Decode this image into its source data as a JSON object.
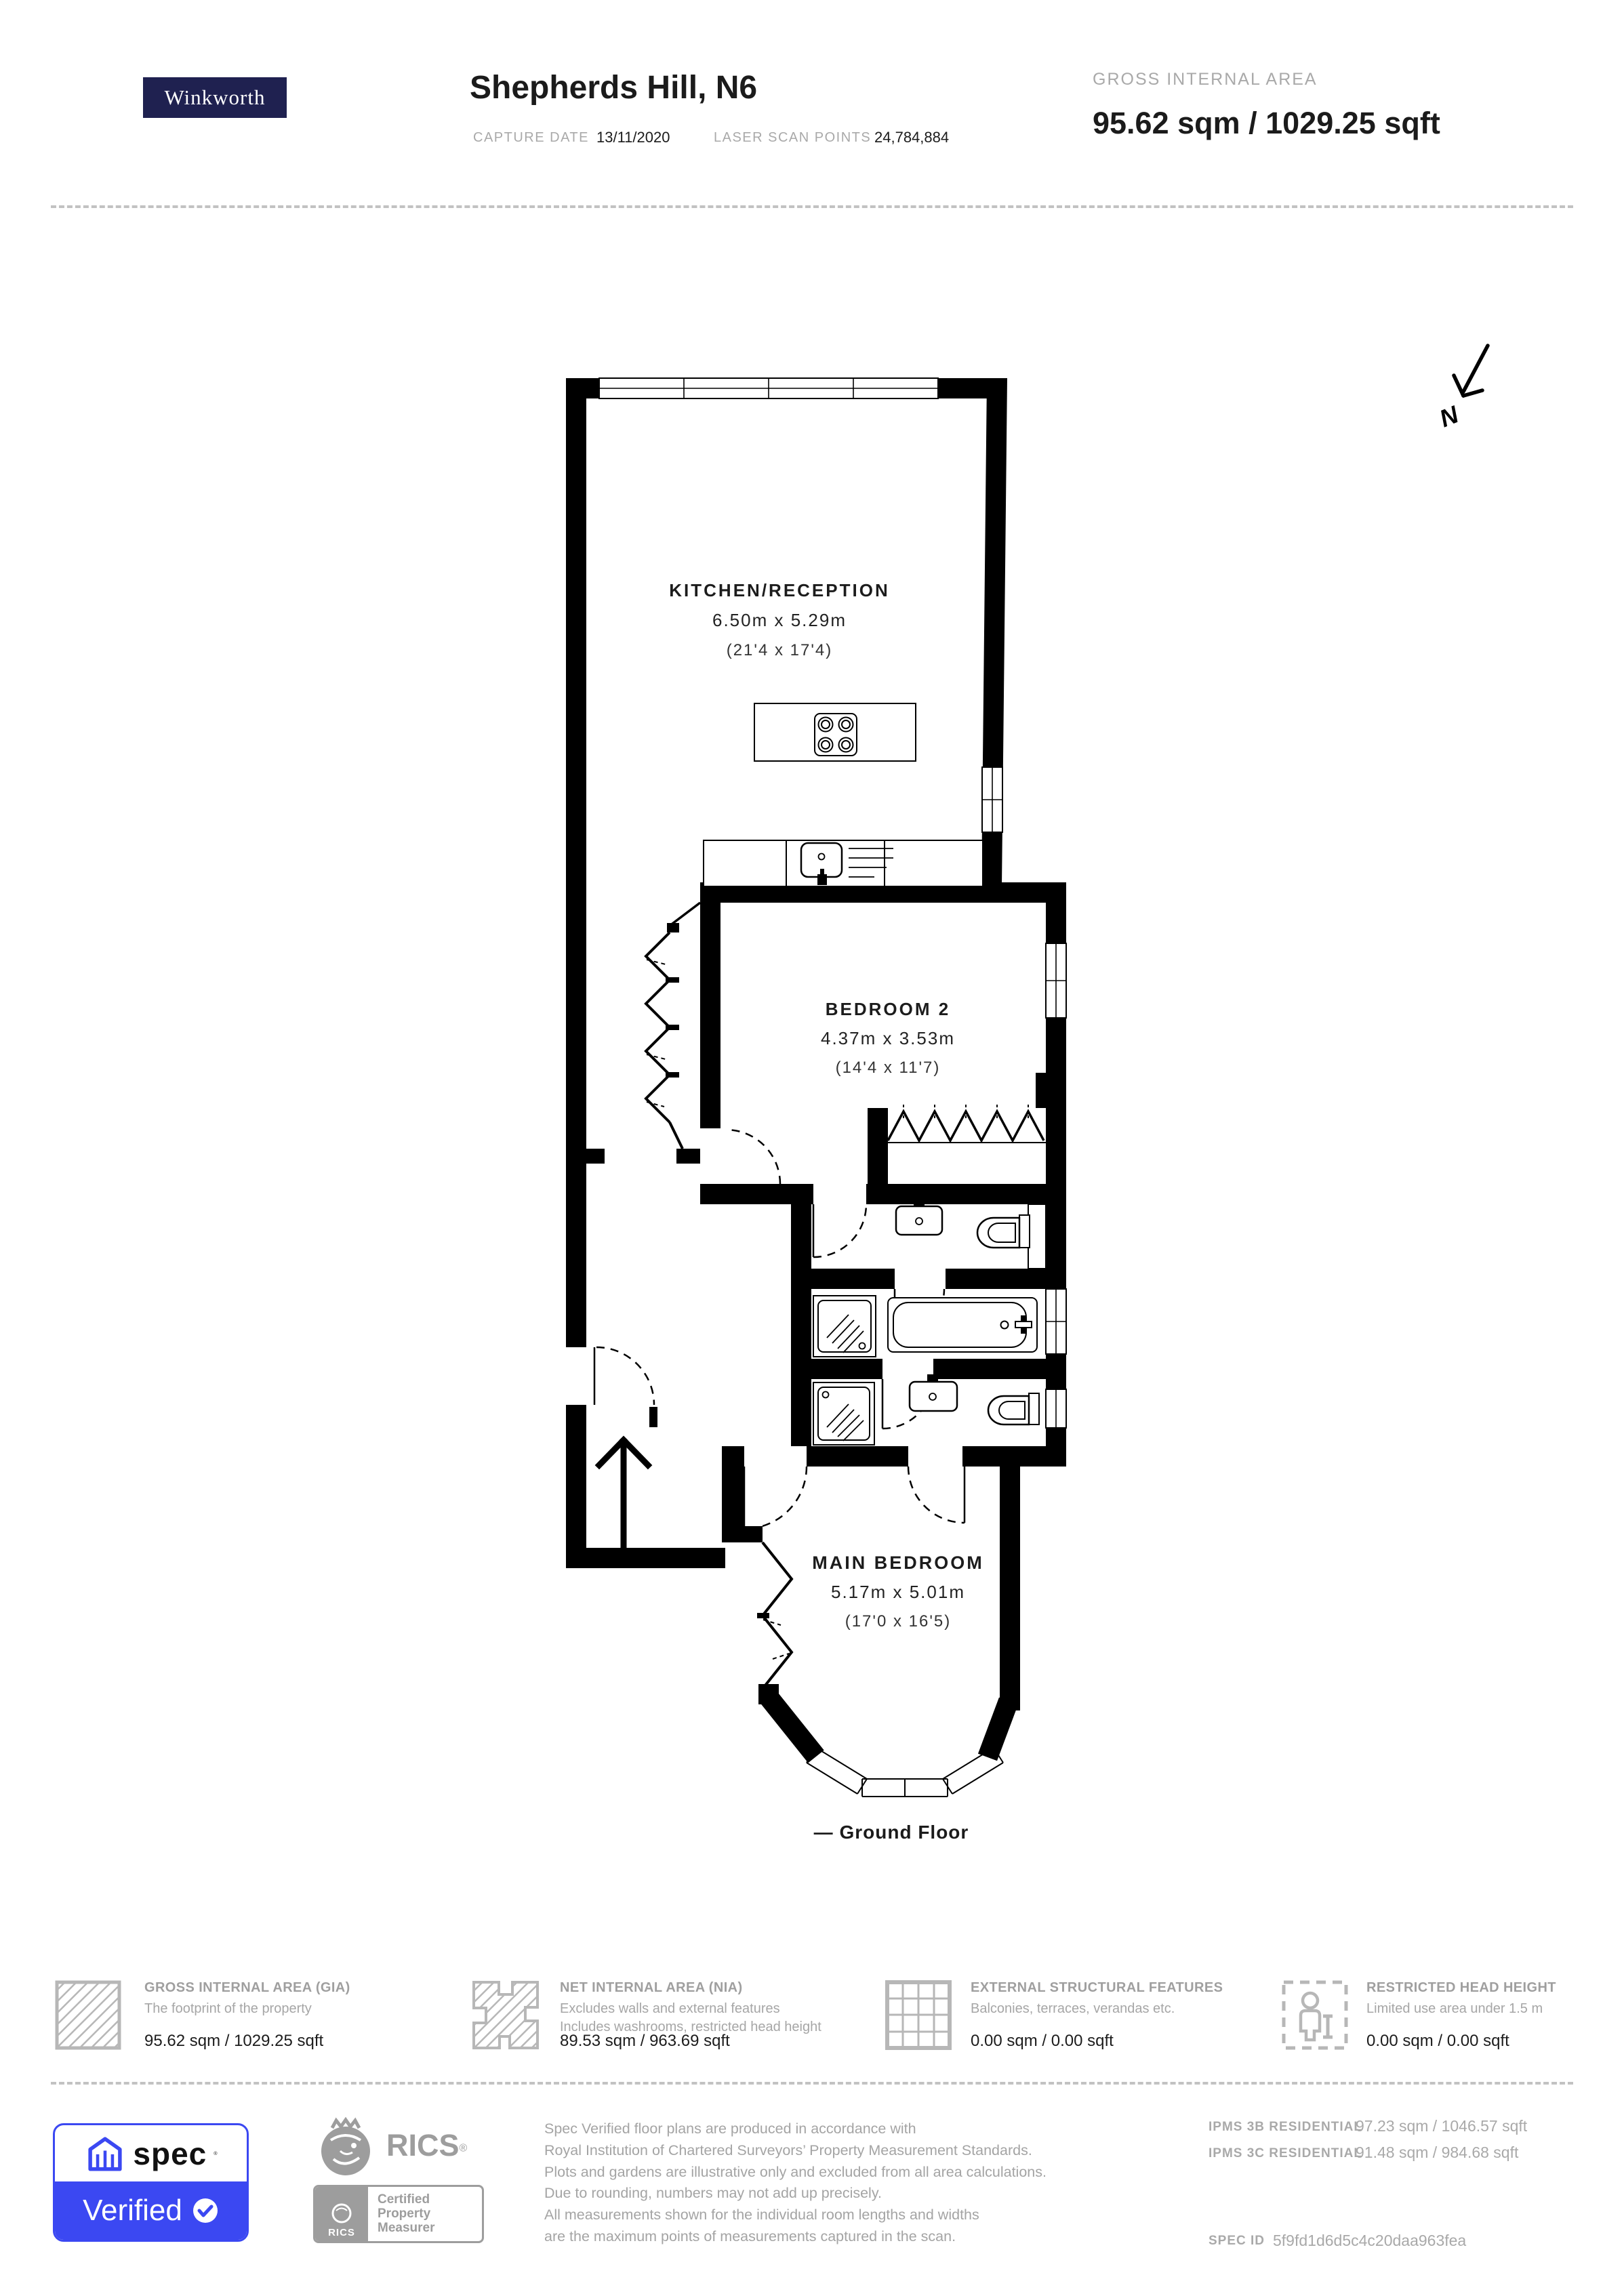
{
  "header": {
    "logo": "Winkworth",
    "title": "Shepherds Hill, N6",
    "capture_label": "CAPTURE DATE",
    "capture_value": "13/11/2020",
    "laser_label": "LASER SCAN POINTS",
    "laser_value": "24,784,884",
    "gia_label": "GROSS INTERNAL AREA",
    "gia_value": "95.62 sqm / 1029.25 sqft"
  },
  "plan": {
    "north": "N",
    "caption": "— Ground Floor",
    "rooms": [
      {
        "name": "KITCHEN/RECEPTION",
        "metric": "6.50m x 5.29m",
        "imperial": "(21'4 x 17'4)"
      },
      {
        "name": "BEDROOM 2",
        "metric": "4.37m x 3.53m",
        "imperial": "(14'4 x 11'7)"
      },
      {
        "name": "MAIN BEDROOM",
        "metric": "5.17m x 5.01m",
        "imperial": "(17'0 x 16'5)"
      }
    ]
  },
  "legend": {
    "items": [
      {
        "label": "GROSS INTERNAL AREA (GIA)",
        "desc": [
          "The footprint of the property"
        ],
        "value": "95.62 sqm / 1029.25 sqft"
      },
      {
        "label": "NET INTERNAL AREA (NIA)",
        "desc": [
          "Excludes walls and external features",
          "Includes washrooms, restricted head height"
        ],
        "value": "89.53 sqm / 963.69 sqft"
      },
      {
        "label": "EXTERNAL STRUCTURAL FEATURES",
        "desc": [
          "Balconies, terraces, verandas etc."
        ],
        "value": "0.00 sqm / 0.00 sqft"
      },
      {
        "label": "RESTRICTED HEAD HEIGHT",
        "desc": [
          "Limited use area under 1.5 m"
        ],
        "value": "0.00 sqm / 0.00 sqft"
      }
    ]
  },
  "footer": {
    "spec_word": "spec",
    "verified_word": "Verified",
    "rics_wordmark": "RICS",
    "rics_small": "RICS",
    "certified_lines": [
      "Certified",
      "Property",
      "Measurer"
    ],
    "disclaimer": [
      "Spec Verified floor plans are produced in accordance with",
      "Royal Institution of Chartered Surveyors’ Property Measurement Standards.",
      "Plots and gardens are illustrative only and excluded from all area calculations.",
      "Due to rounding, numbers may not add up precisely.",
      "All measurements shown for the individual room lengths and widths",
      "are the maximum points of measurements captured in the scan."
    ],
    "ipms": [
      {
        "label": "IPMS 3B RESIDENTIAL",
        "value": "97.23 sqm / 1046.57 sqft"
      },
      {
        "label": "IPMS 3C RESIDENTIAL",
        "value": "91.48 sqm / 984.68 sqft"
      }
    ],
    "spec_id_label": "SPEC ID",
    "spec_id_value": "5f9fd1d6d5c4c20daa963fea"
  }
}
